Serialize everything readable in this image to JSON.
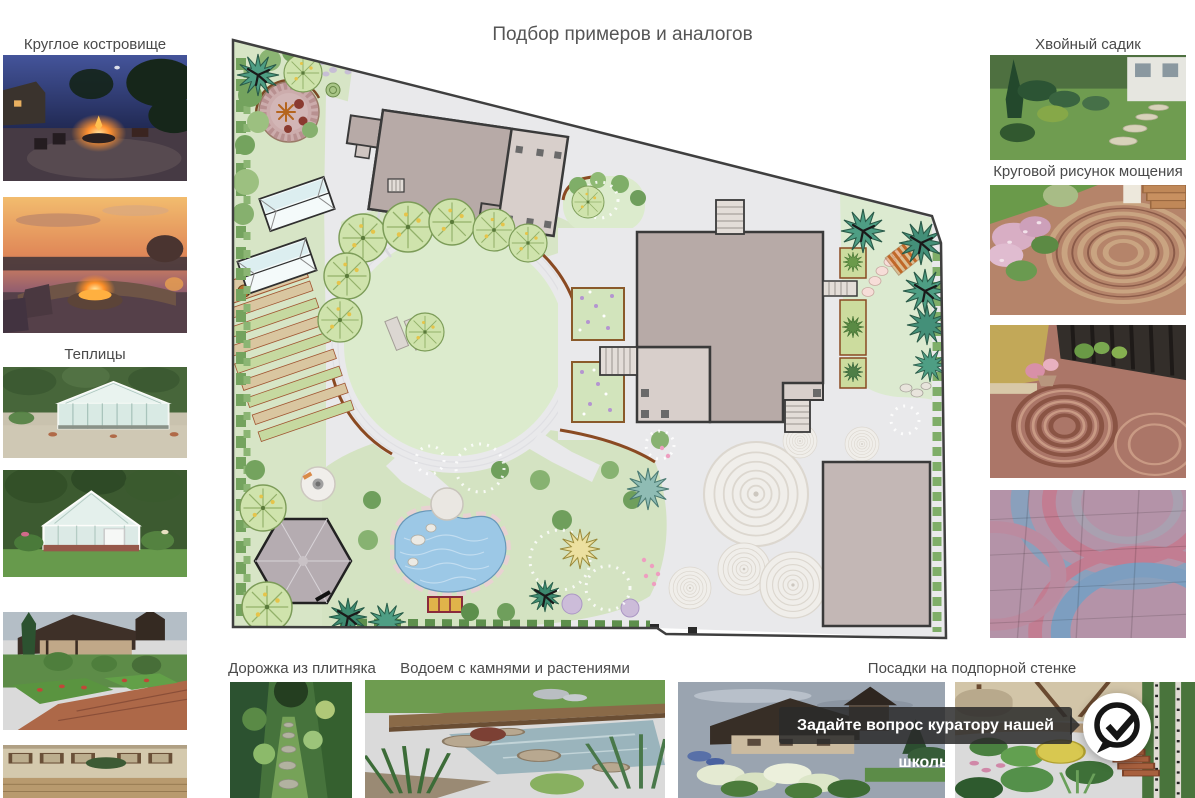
{
  "page": {
    "title": "Подбор примеров и аналогов"
  },
  "captions": {
    "fire_pit": "Круглое костровище",
    "greenhouses": "Теплицы",
    "conifer_garden": "Хвойный садик",
    "circular_paving": "Круговой рисунок мощения",
    "flagstone_path": "Дорожка из плитняка",
    "pond": "Водоем с камнями и растениями",
    "retaining_wall": "Посадки на подпорной стенке"
  },
  "chat": {
    "tooltip_text": "Задайте вопрос куратору нашей школы"
  },
  "colors": {
    "label_text": "#4a4a4a",
    "tooltip_bg": "#2a2a2a",
    "plan_lawn": "#dcebcd",
    "plan_paving": "#e9e9eb",
    "plan_building": "#b7aaa7",
    "pond_water": "#9cc8e6"
  }
}
